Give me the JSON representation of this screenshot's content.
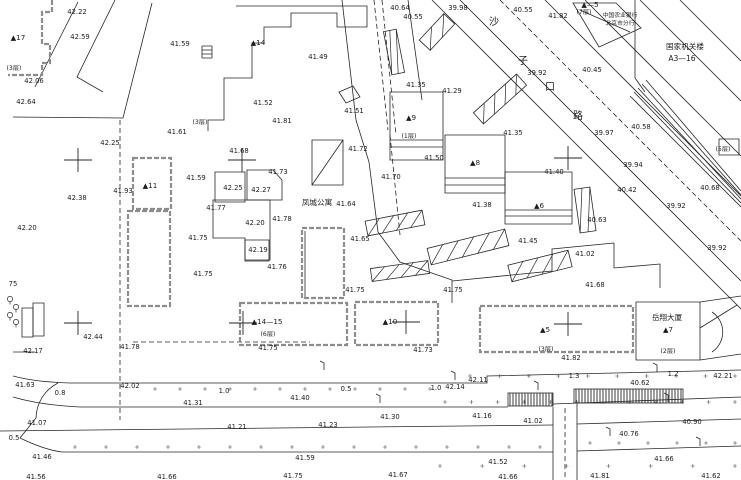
{
  "map": {
    "background": "#ffffff",
    "line_color": "#262626",
    "parcel_color": "#8d8d8d",
    "elevations": [
      [
        77,
        12,
        "42.22"
      ],
      [
        80,
        37,
        "42.59"
      ],
      [
        34,
        81,
        "42.06"
      ],
      [
        26,
        102,
        "42.64"
      ],
      [
        180,
        44,
        "41.59"
      ],
      [
        177,
        132,
        "41.61"
      ],
      [
        318,
        57,
        "41.49"
      ],
      [
        263,
        103,
        "41.52"
      ],
      [
        354,
        111,
        "41.51"
      ],
      [
        282,
        121,
        "41.81"
      ],
      [
        400,
        8,
        "40.64"
      ],
      [
        413,
        17,
        "40.55"
      ],
      [
        458,
        8,
        "39.98"
      ],
      [
        523,
        10,
        "40.55"
      ],
      [
        558,
        16,
        "41.82"
      ],
      [
        537,
        73,
        "39.92"
      ],
      [
        592,
        70,
        "40.45"
      ],
      [
        641,
        127,
        "40.58"
      ],
      [
        604,
        133,
        "39.97"
      ],
      [
        633,
        165,
        "39.94"
      ],
      [
        627,
        190,
        "40.42"
      ],
      [
        676,
        206,
        "39.92"
      ],
      [
        710,
        188,
        "40.68"
      ],
      [
        717,
        248,
        "39.92"
      ],
      [
        452,
        91,
        "41.29"
      ],
      [
        416,
        85,
        "41.35"
      ],
      [
        434,
        158,
        "41.50"
      ],
      [
        513,
        133,
        "41.35"
      ],
      [
        554,
        172,
        "41.40"
      ],
      [
        358,
        149,
        "41.72"
      ],
      [
        391,
        177,
        "41.70"
      ],
      [
        346,
        204,
        "41.64"
      ],
      [
        482,
        205,
        "41.38"
      ],
      [
        360,
        239,
        "41.65"
      ],
      [
        528,
        241,
        "41.45"
      ],
      [
        355,
        290,
        "41.75"
      ],
      [
        453,
        290,
        "41.75"
      ],
      [
        239,
        151,
        "41.68"
      ],
      [
        278,
        172,
        "41.73"
      ],
      [
        196,
        178,
        "41.59"
      ],
      [
        233,
        188,
        "42.25"
      ],
      [
        261,
        190,
        "42.27"
      ],
      [
        216,
        208,
        "41.77"
      ],
      [
        255,
        223,
        "42.20"
      ],
      [
        282,
        219,
        "41.78"
      ],
      [
        198,
        238,
        "41.75"
      ],
      [
        258,
        250,
        "42.19"
      ],
      [
        277,
        267,
        "41.76"
      ],
      [
        203,
        274,
        "41.75"
      ],
      [
        110,
        143,
        "42.25"
      ],
      [
        77,
        198,
        "42.38"
      ],
      [
        123,
        191,
        "41.93"
      ],
      [
        27,
        228,
        "42.20"
      ],
      [
        13,
        284,
        "75"
      ],
      [
        597,
        220,
        "40.63"
      ],
      [
        585,
        254,
        "41.02"
      ],
      [
        595,
        285,
        "41.68"
      ],
      [
        93,
        337,
        "42.44"
      ],
      [
        33,
        351,
        "42.17"
      ],
      [
        130,
        347,
        "41.78"
      ],
      [
        25,
        385,
        "41.63"
      ],
      [
        60,
        393,
        "0.8"
      ],
      [
        130,
        386,
        "42.02"
      ],
      [
        224,
        391,
        "1.0"
      ],
      [
        193,
        403,
        "41.31"
      ],
      [
        37,
        423,
        "41.07"
      ],
      [
        237,
        427,
        "41.21"
      ],
      [
        14,
        438,
        "0.5"
      ],
      [
        42,
        457,
        "41.46"
      ],
      [
        36,
        477,
        "41.56"
      ],
      [
        167,
        477,
        "41.66"
      ],
      [
        268,
        348,
        "41.75"
      ],
      [
        423,
        350,
        "41.73"
      ],
      [
        346,
        389,
        "0.5"
      ],
      [
        300,
        398,
        "41.40"
      ],
      [
        436,
        388,
        "1.0"
      ],
      [
        455,
        387,
        "42.14"
      ],
      [
        478,
        380,
        "42.11"
      ],
      [
        390,
        417,
        "41.30"
      ],
      [
        482,
        416,
        "41.16"
      ],
      [
        328,
        425,
        "41.23"
      ],
      [
        305,
        458,
        "41.59"
      ],
      [
        293,
        476,
        "41.75"
      ],
      [
        398,
        475,
        "41.67"
      ],
      [
        571,
        358,
        "41.82"
      ],
      [
        574,
        376,
        "1.3"
      ],
      [
        673,
        374,
        "1.2"
      ],
      [
        723,
        376,
        "42.21"
      ],
      [
        640,
        383,
        "40.62"
      ],
      [
        533,
        421,
        "41.02"
      ],
      [
        692,
        422,
        "40.90"
      ],
      [
        629,
        434,
        "40.76"
      ],
      [
        498,
        462,
        "41.52"
      ],
      [
        664,
        459,
        "41.66"
      ],
      [
        508,
        477,
        "41.66"
      ],
      [
        600,
        476,
        "41.81"
      ],
      [
        711,
        476,
        "41.62"
      ]
    ],
    "buildings": [
      [
        18,
        38,
        "▲17"
      ],
      [
        258,
        43,
        "▲14"
      ],
      [
        150,
        186,
        "▲11"
      ],
      [
        411,
        118,
        "▲9"
      ],
      [
        475,
        163,
        "▲8"
      ],
      [
        539,
        206,
        "▲6"
      ],
      [
        267,
        322,
        "▲14—15"
      ],
      [
        390,
        322,
        "▲10"
      ],
      [
        545,
        330,
        "▲5"
      ],
      [
        668,
        330,
        "▲7"
      ],
      [
        590,
        5,
        "▲—5"
      ]
    ],
    "floors": [
      [
        14,
        68,
        "(3层)"
      ],
      [
        200,
        122,
        "(3层)"
      ],
      [
        584,
        12,
        "(7层)"
      ],
      [
        409,
        136,
        "(1层)"
      ],
      [
        723,
        149,
        "(5层)"
      ],
      [
        268,
        334,
        "(6层)"
      ],
      [
        546,
        349,
        "(3层)"
      ],
      [
        668,
        351,
        "(2层)"
      ]
    ],
    "texts": [
      {
        "x": 317,
        "y": 203,
        "t": "凤城公寓",
        "cls": "cn",
        "name": "apartment-name"
      },
      {
        "x": 620,
        "y": 15,
        "t": "中国农业银行",
        "cls": "cn-small",
        "name": "bank-name-line1"
      },
      {
        "x": 620,
        "y": 23,
        "t": "北京市分行",
        "cls": "cn-small",
        "name": "bank-name-line2"
      },
      {
        "x": 685,
        "y": 47,
        "t": "国家机关楼",
        "cls": "cn",
        "name": "gov-building-name"
      },
      {
        "x": 682,
        "y": 59,
        "t": "A3—16",
        "cls": "cn",
        "name": "gov-building-code"
      },
      {
        "x": 667,
        "y": 318,
        "t": "岳翔大厦",
        "cls": "cn",
        "name": "tower-name"
      }
    ],
    "street_chars": [
      [
        494,
        21,
        "沙"
      ],
      [
        523,
        60,
        "子"
      ],
      [
        550,
        86,
        "口"
      ],
      [
        578,
        115,
        "路"
      ]
    ],
    "crosses": [
      [
        78,
        160
      ],
      [
        242,
        160
      ],
      [
        568,
        158
      ],
      [
        78,
        323
      ],
      [
        243,
        323
      ],
      [
        406,
        322
      ],
      [
        568,
        324
      ]
    ],
    "geometry": {
      "solid": [
        "M78,2 L35,87",
        "M115,0 L77,77 L103,92",
        "M152,3 L123,118 L13,117",
        "M236,6 L367,6 L367,27 L337,27 L337,13 L291,13 L291,27 L264,27 L264,43 L252,43 L252,78 L224,78 L224,120 L208,120 L208,131",
        "M202,46 h10 M202,50 h10 M202,54 h10 M202,58 h10 M202,46 v12 M212,46 v12",
        "M342,0 L356,120 L369,162",
        "M408,0 L422,100",
        "M369,162 L378,232 L400,262 L452,280 L452,303",
        "M432,0 L741,309",
        "M460,0 L741,281",
        "M545,0 L741,196",
        "M585,0 L741,156",
        "M640,0 L741,101",
        "M680,0 L741,61",
        "M630,96 L741,207",
        "M634,92 L741,203",
        "M638,88 L741,199",
        "M642,84 L741,195",
        "M646,80 L741,191",
        "M635,0 L635,78 L645,92",
        "M719,139 h20 v16 h-20 z",
        "M390,92 h53 v68 h-53 z",
        "M390,140 h53",
        "M390,147 h53",
        "M445,135 h60 v58 h-60 z",
        "M445,178 h60",
        "M445,185 h60",
        "M505,172 h67 v52 h-67 z",
        "M505,210 h67",
        "M505,216 h67",
        "M573,3 L616,3 L641,28 L599,47 Z",
        "M580,10 L630,32",
        "M636,302 h64 v58 h-64 z",
        "M712,312 A24 24 0 0 1 712,352",
        "M700,302 L741,296",
        "M700,360 L741,354",
        "M700,328 L737,305",
        "M215,172 h30 v30 h-30 z",
        "M247,170 h26 l9,10 v20 h-35 z",
        "M213,200 h57 v60 h-25 v-22 h-32 z",
        "M245,240 h24 v21 h-24 z",
        "M312,140 h31 v45 h-31 z",
        "M312,185 L343,140",
        "M339,92 l14,-6 l7,11 l-14,6 z",
        "M305,231 L305,297",
        "M452,281 L552,271 L552,249 L614,243",
        "M614,243 L614,268 L660,264 L660,288",
        "M13,376 Q35,382 70,383 L452,383",
        "M452,383 L487,383 L487,376 L741,370",
        "M13,397 Q40,405 80,407 L508,407",
        "M553,404 L741,397",
        "M0,431 L553,425",
        "M577,424 L741,419",
        "M20,438 Q45,450 62,452 L553,452",
        "M577,451 L741,446",
        "M58,383 A40 40 0 0 0 36,418",
        "M36,418 Q28,428 20,438",
        "M553,407 L553,480",
        "M577,403 L577,480",
        "M22,308 h11 v29 h-11 z",
        "M33,303 h11 v33 h-11 z",
        "M13,352 L35,352"
      ],
      "dashed": [
        "M374,0 L388,130",
        "M382,0 L396,135",
        "M390,135 L400,235",
        "M120,120 L120,420",
        "M500,0 L741,241",
        "M565,408 L565,480",
        "M133,342 L310,342"
      ],
      "parcel": [
        "M52,0 L52,12 L42,12 L42,44 L50,44 L50,63 L42,63 L42,75 L8,75",
        "M133,158 h38 v51 h-38 z",
        "M128,211 h42 v95 h-42 z",
        "M302,228 h42 v70 h-42 z",
        "M240,303 h107 v42 h-107 z",
        "M355,302 h83 v43 h-83 z",
        "M480,306 h153 v46 h-153 z"
      ],
      "slopes": [
        {
          "cx": 395,
          "cy": 223,
          "w": 58,
          "h": 15,
          "a": -11
        },
        {
          "cx": 468,
          "cy": 247,
          "w": 80,
          "h": 17,
          "a": -14
        },
        {
          "cx": 540,
          "cy": 266,
          "w": 62,
          "h": 17,
          "a": -14
        },
        {
          "cx": 400,
          "cy": 271,
          "w": 58,
          "h": 13,
          "a": -8
        },
        {
          "cx": 585,
          "cy": 210,
          "w": 16,
          "h": 44,
          "a": -8
        },
        {
          "cx": 500,
          "cy": 99,
          "w": 58,
          "h": 15,
          "a": -42
        },
        {
          "cx": 437,
          "cy": 32,
          "w": 36,
          "h": 15,
          "a": -47
        },
        {
          "cx": 394,
          "cy": 52,
          "w": 13,
          "h": 44,
          "a": -11
        }
      ],
      "crosswalks": [
        {
          "x": 508,
          "y": 393,
          "w": 45,
          "h": 13
        },
        {
          "x": 574,
          "y": 389,
          "w": 109,
          "h": 14
        }
      ]
    },
    "dot_rows": [
      {
        "y": 389,
        "x1": 155,
        "x2": 430,
        "n": 12
      },
      {
        "y": 402,
        "x1": 445,
        "x2": 735,
        "n": 12
      },
      {
        "y": 376,
        "x1": 470,
        "x2": 735,
        "n": 10
      },
      {
        "y": 447,
        "x1": 75,
        "x2": 540,
        "n": 16
      },
      {
        "y": 443,
        "x1": 590,
        "x2": 735,
        "n": 6
      },
      {
        "y": 466,
        "x1": 440,
        "x2": 735,
        "n": 8
      }
    ],
    "trees": [
      [
        10,
        299
      ],
      [
        16,
        307
      ],
      [
        10,
        315
      ],
      [
        16,
        322
      ]
    ],
    "poles": [
      [
        324,
        370
      ],
      [
        380,
        403
      ],
      [
        455,
        380
      ],
      [
        610,
        436
      ],
      [
        657,
        372
      ],
      [
        700,
        446
      ],
      [
        538,
        390
      ],
      [
        668,
        402
      ]
    ]
  }
}
